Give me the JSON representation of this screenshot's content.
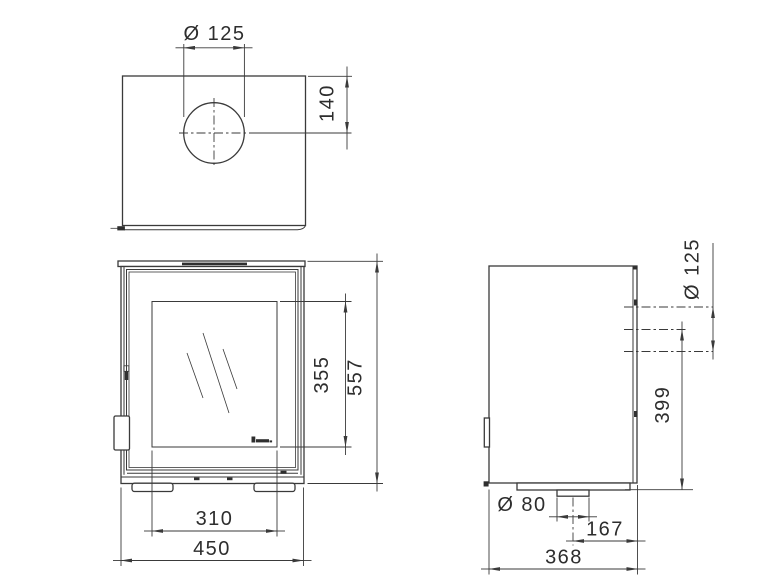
{
  "drawing": {
    "type": "technical-dimension-drawing",
    "subject": "stove with glass door — three orthographic views",
    "units": "mm"
  },
  "style": {
    "line_color": "#3a3a3a",
    "text_color": "#2d2d2d",
    "background": "#ffffff"
  },
  "icons": {
    "brand_logo": "brand-logo-mark"
  },
  "views": {
    "top": {
      "label": "top view",
      "dimensions": {
        "flue_diameter": "Ø 125",
        "flue_center_from_back_edge": "140"
      }
    },
    "front": {
      "label": "front view",
      "dimensions": {
        "glass_height": "355",
        "overall_height": "557",
        "glass_width": "310",
        "overall_width": "450"
      }
    },
    "side": {
      "label": "side view",
      "dimensions": {
        "rear_flue_diameter": "Ø 125",
        "rear_flue_center_height": "399",
        "air_inlet_diameter": "Ø 80",
        "air_inlet_center_from_back": "167",
        "overall_depth": "368"
      }
    }
  }
}
